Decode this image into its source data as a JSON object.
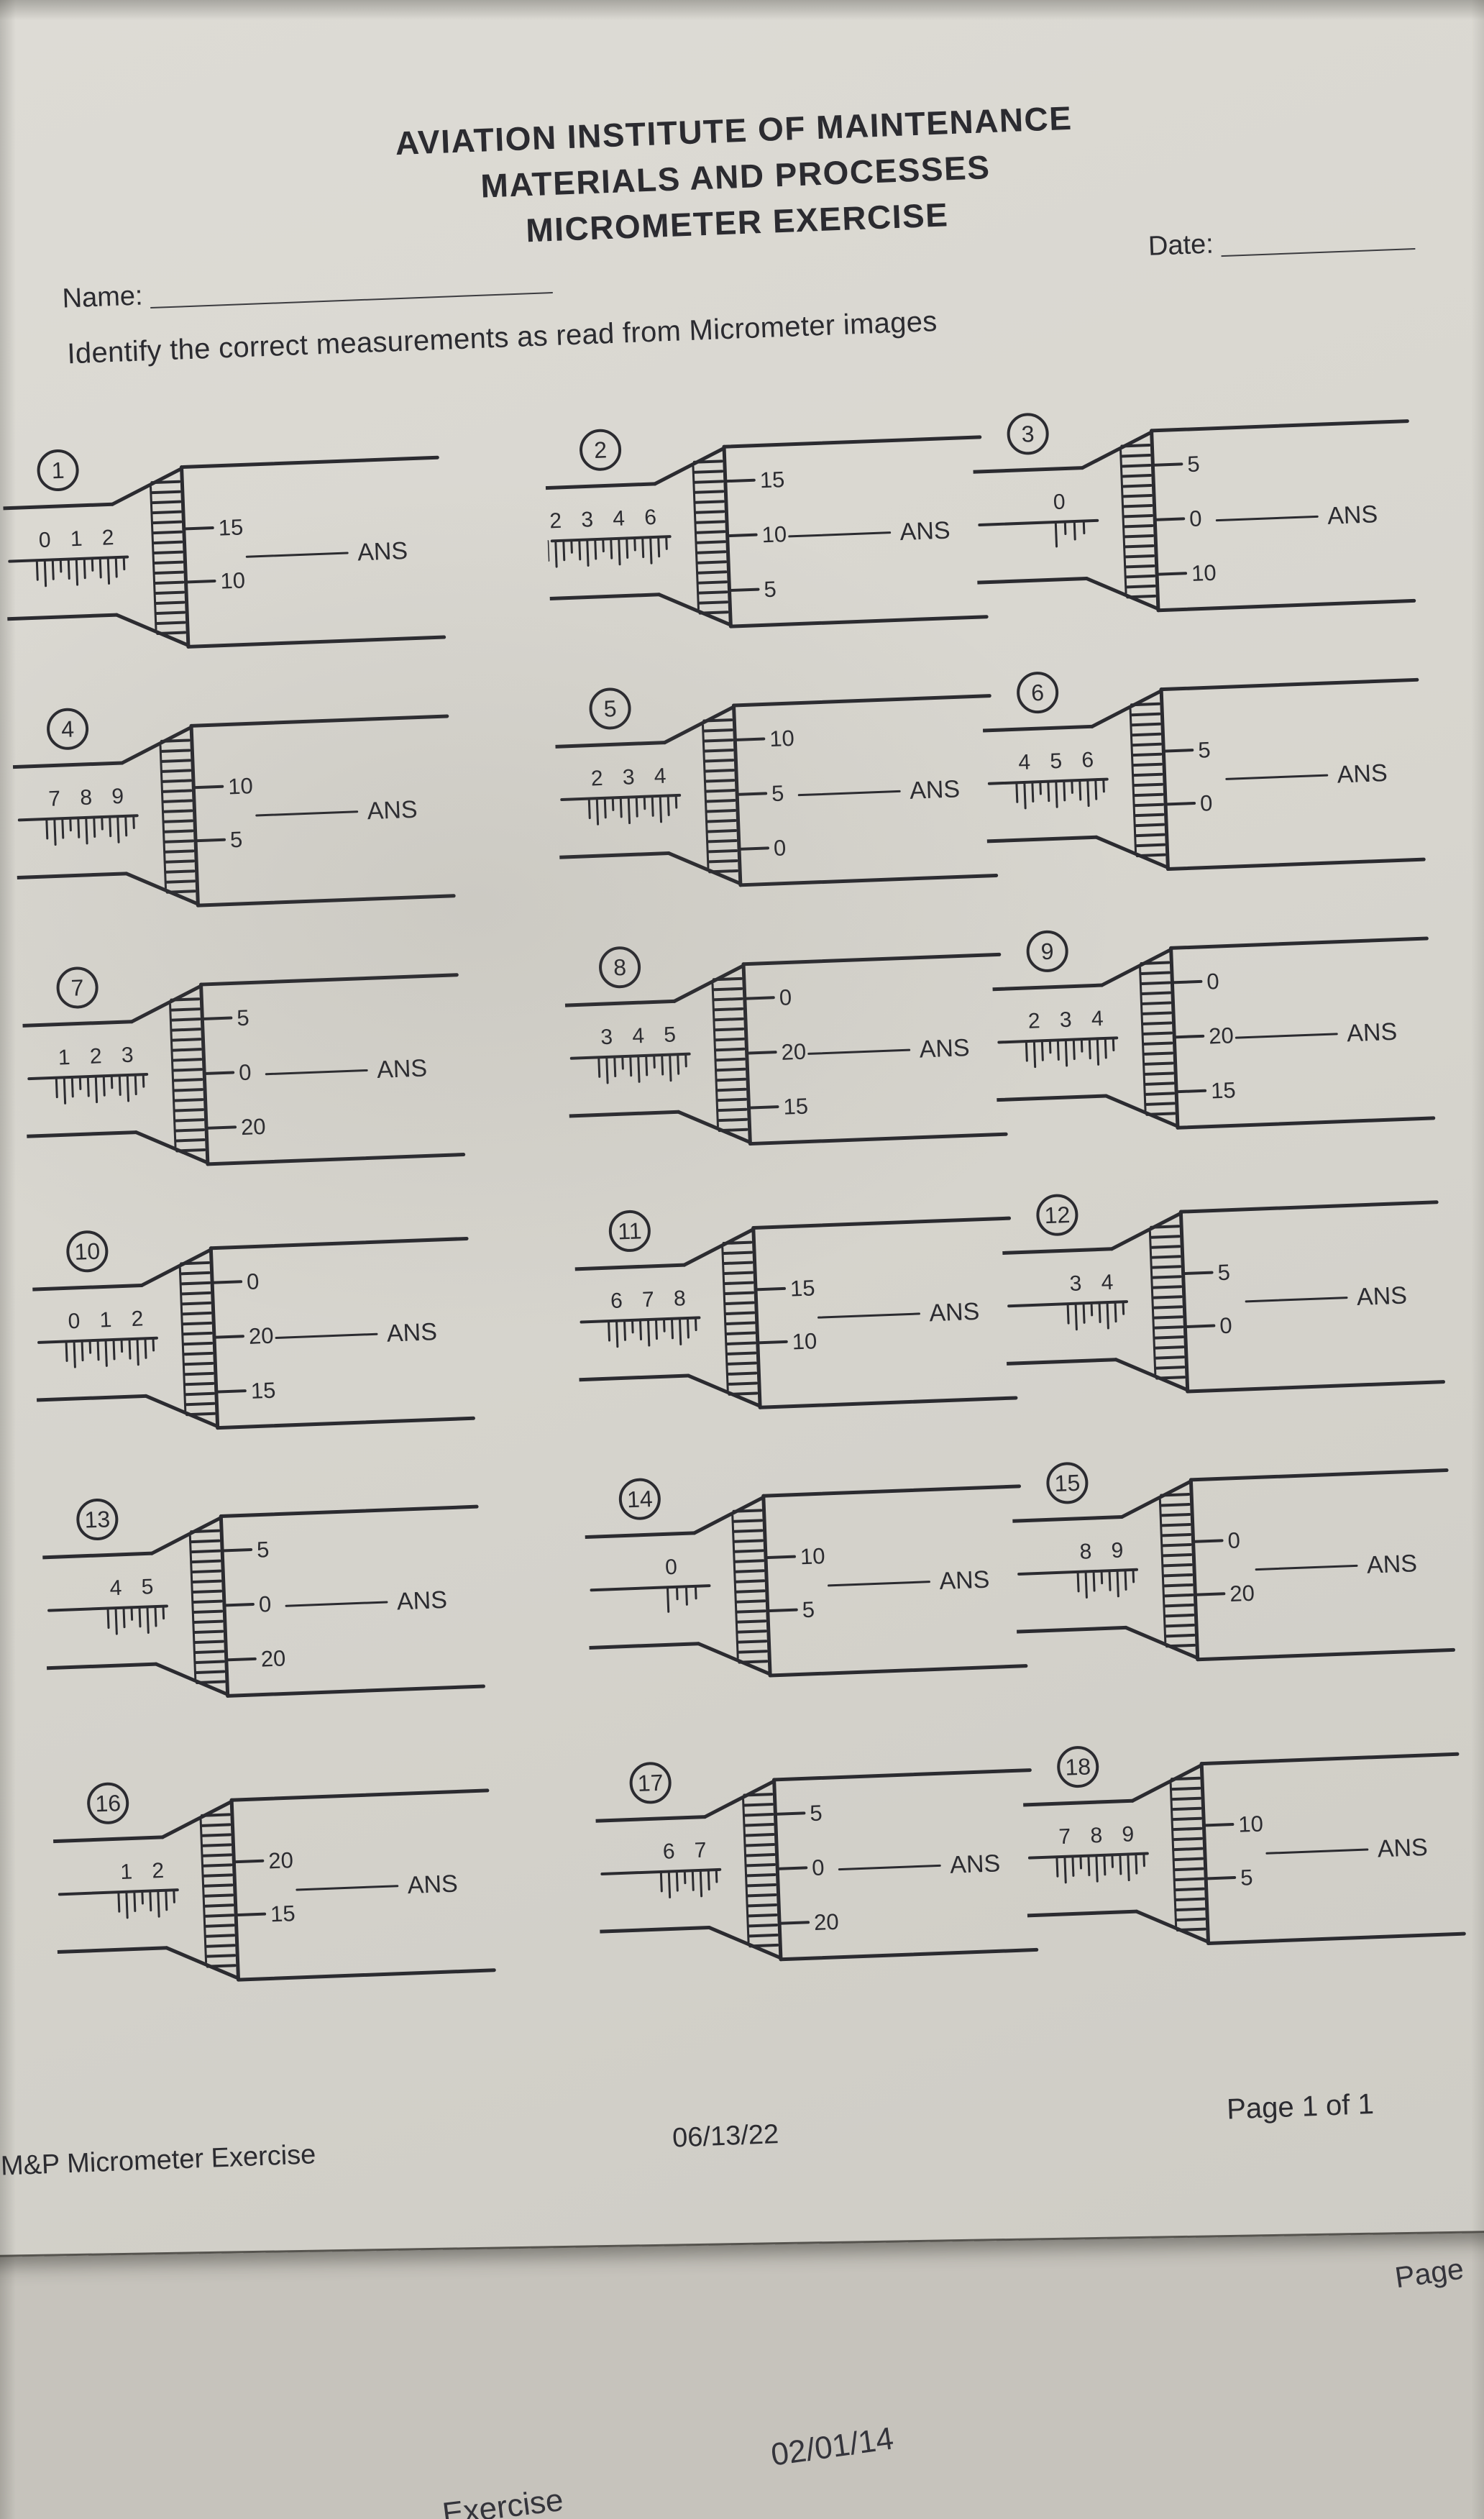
{
  "colors": {
    "paper": "#d8d6cf",
    "under_paper": "#c6c3bc",
    "ink": "#2b2b30"
  },
  "labels": {
    "ans": "ANS"
  },
  "header": {
    "title_line1": "AVIATION INSTITUTE OF MAINTENANCE",
    "title_line2": "MATERIALS AND PROCESSES",
    "title_line3": "MICROMETER EXERCISE",
    "date_label": "Date:",
    "name_label": "Name:",
    "instruction": "Identify the correct measurements as read from Micrometer images"
  },
  "problems": [
    {
      "num": "1",
      "sleeve": [
        "0",
        "1",
        "2"
      ],
      "thimble": [
        "15",
        "10"
      ]
    },
    {
      "num": "2",
      "sleeve": [
        "2",
        "3",
        "4",
        "6"
      ],
      "thimble": [
        "15",
        "10",
        "5"
      ]
    },
    {
      "num": "3",
      "sleeve": [
        "0"
      ],
      "thimble": [
        "5",
        "0",
        "10"
      ]
    },
    {
      "num": "4",
      "sleeve": [
        "7",
        "8",
        "9"
      ],
      "thimble": [
        "10",
        "5"
      ]
    },
    {
      "num": "5",
      "sleeve": [
        "2",
        "3",
        "4"
      ],
      "thimble": [
        "10",
        "5",
        "0"
      ]
    },
    {
      "num": "6",
      "sleeve": [
        "4",
        "5",
        "6"
      ],
      "thimble": [
        "5",
        "0"
      ]
    },
    {
      "num": "7",
      "sleeve": [
        "1",
        "2",
        "3"
      ],
      "thimble": [
        "5",
        "0",
        "20"
      ]
    },
    {
      "num": "8",
      "sleeve": [
        "3",
        "4",
        "5"
      ],
      "thimble": [
        "0",
        "20",
        "15"
      ]
    },
    {
      "num": "9",
      "sleeve": [
        "2",
        "3",
        "4"
      ],
      "thimble": [
        "0",
        "20",
        "15"
      ]
    },
    {
      "num": "10",
      "sleeve": [
        "0",
        "1",
        "2"
      ],
      "thimble": [
        "0",
        "20",
        "15"
      ]
    },
    {
      "num": "11",
      "sleeve": [
        "6",
        "7",
        "8"
      ],
      "thimble": [
        "15",
        "10"
      ]
    },
    {
      "num": "12",
      "sleeve": [
        "3",
        "4"
      ],
      "thimble": [
        "5",
        "0"
      ]
    },
    {
      "num": "13",
      "sleeve": [
        "4",
        "5"
      ],
      "thimble": [
        "5",
        "0",
        "20"
      ]
    },
    {
      "num": "14",
      "sleeve": [
        "0"
      ],
      "thimble": [
        "10",
        "5"
      ]
    },
    {
      "num": "15",
      "sleeve": [
        "8",
        "9"
      ],
      "thimble": [
        "0",
        "20"
      ]
    },
    {
      "num": "16",
      "sleeve": [
        "1",
        "2"
      ],
      "thimble": [
        "20",
        "15"
      ]
    },
    {
      "num": "17",
      "sleeve": [
        "6",
        "7"
      ],
      "thimble": [
        "5",
        "0",
        "20"
      ]
    },
    {
      "num": "18",
      "sleeve": [
        "7",
        "8",
        "9"
      ],
      "thimble": [
        "10",
        "5"
      ]
    }
  ],
  "footer": {
    "doc_title": "M&P Micrometer Exercise",
    "date": "06/13/22",
    "page": "Page 1 of 1"
  },
  "under_sheet": {
    "page_label": "Page",
    "date": "02/01/14",
    "partial_text": "Exercise"
  }
}
